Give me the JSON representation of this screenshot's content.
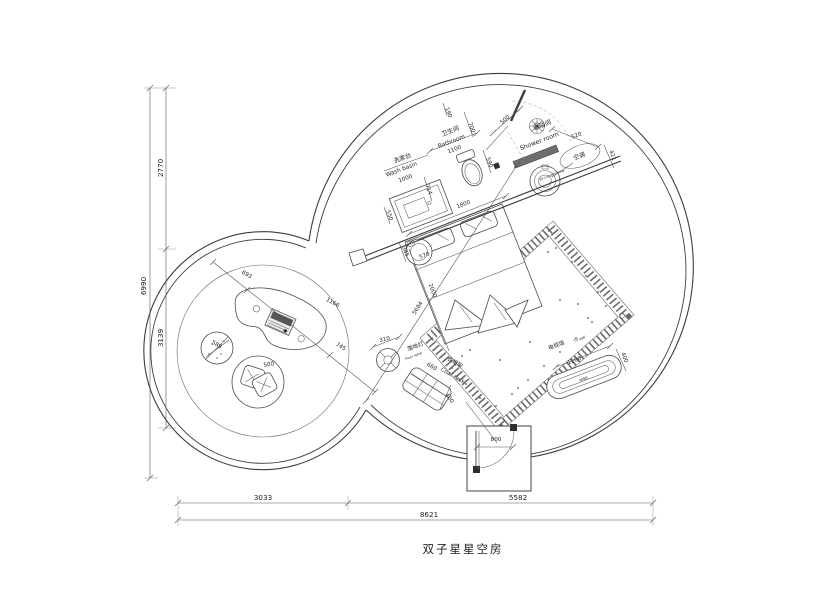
{
  "title": {
    "text": "双子星星空房"
  },
  "drawing": {
    "type": "floor-plan",
    "room_name": "双子星星空房",
    "overall_dimensions": {
      "total_width_mm": 8621,
      "total_height_mm": 6990,
      "bottom_segments_mm": [
        3033,
        5582
      ],
      "left_segments_mm": [
        2770,
        3139
      ]
    },
    "areas": [
      {
        "name_cn": "卫生间",
        "name_en": "Bathroom",
        "width_mm": 1100
      },
      {
        "name_cn": "淋浴间",
        "name_en": "Shower room"
      },
      {
        "name_cn": "洗漱台",
        "name_en": "Wash basin",
        "width_mm": 1000
      },
      {
        "name_cn": "空调",
        "name_en": "air-conditioning"
      },
      {
        "name_cn": "落地灯",
        "name_en": "Floor lamp",
        "dim_mm": 310
      },
      {
        "name_cn": "衣帽架",
        "name_en": "Coat rack",
        "dims_mm": [
          660,
          400
        ]
      },
      {
        "name_cn": "电视墙",
        "name_en": "TV wall",
        "dims_mm": [
          1200,
          400
        ]
      },
      {
        "name_cn": "电视机",
        "name_en": ""
      }
    ],
    "labels": [
      {
        "name": "dim-2770",
        "text": "2770",
        "x": 163,
        "y": 168,
        "rot": -90,
        "size": 7.2
      },
      {
        "name": "dim-3139",
        "text": "3139",
        "x": 163,
        "y": 338,
        "rot": -90,
        "size": 7.2
      },
      {
        "name": "dim-6990",
        "text": "6990",
        "x": 146,
        "y": 286,
        "rot": -90,
        "size": 7.2
      },
      {
        "name": "dim-3033",
        "text": "3033",
        "x": 263,
        "y": 500,
        "rot": 0,
        "size": 7.2
      },
      {
        "name": "dim-5582",
        "text": "5582",
        "x": 518,
        "y": 500,
        "rot": 0,
        "size": 7.2
      },
      {
        "name": "dim-8621",
        "text": "8621",
        "x": 429,
        "y": 517,
        "rot": 0,
        "size": 7.2
      },
      {
        "name": "label-washbasin-cn",
        "text": "洗漱台",
        "x": 403,
        "y": 160,
        "rot": -21,
        "size": 6.2
      },
      {
        "name": "label-washbasin-en",
        "text": "Wash basin",
        "x": 402,
        "y": 171,
        "rot": -21,
        "size": 5.8
      },
      {
        "name": "dim-1000",
        "text": "1000",
        "x": 406,
        "y": 180,
        "rot": -21,
        "size": 5.6
      },
      {
        "name": "dim-550",
        "text": "550",
        "x": 388,
        "y": 216,
        "rot": 69,
        "size": 5.6
      },
      {
        "name": "label-bathroom-cn",
        "text": "卫生间",
        "x": 451,
        "y": 133,
        "rot": -21,
        "size": 6.2
      },
      {
        "name": "label-bathroom-en",
        "text": "Bathroom",
        "x": 452,
        "y": 143,
        "rot": -21,
        "size": 5.8
      },
      {
        "name": "dim-1100",
        "text": "1100",
        "x": 455,
        "y": 151,
        "rot": -21,
        "size": 5.6
      },
      {
        "name": "dim-190",
        "text": "190",
        "x": 447,
        "y": 113,
        "rot": 69,
        "size": 5.6
      },
      {
        "name": "dim-700",
        "text": "700",
        "x": 470,
        "y": 128,
        "rot": 69,
        "size": 5.6
      },
      {
        "name": "dim-500-door",
        "text": "500",
        "x": 506,
        "y": 121,
        "rot": -40,
        "size": 5.6
      },
      {
        "name": "dim-590",
        "text": "590",
        "x": 488,
        "y": 163,
        "rot": 69,
        "size": 5.6
      },
      {
        "name": "dim-714",
        "text": "714",
        "x": 427,
        "y": 190,
        "rot": 69,
        "size": 5.6
      },
      {
        "name": "dim-1800",
        "text": "1800",
        "x": 464,
        "y": 206,
        "rot": -21,
        "size": 5.6
      },
      {
        "name": "label-shower-cn",
        "text": "淋浴间",
        "x": 543,
        "y": 127,
        "rot": -21,
        "size": 6.2
      },
      {
        "name": "label-shower-en",
        "text": "Shower room",
        "x": 540,
        "y": 143,
        "rot": -21,
        "size": 6.2
      },
      {
        "name": "dim-520",
        "text": "520",
        "x": 577,
        "y": 137,
        "rot": -21,
        "size": 5.6
      },
      {
        "name": "dim-421",
        "text": "421",
        "x": 611,
        "y": 156,
        "rot": 69,
        "size": 5.6
      },
      {
        "name": "label-ac-cn",
        "text": "空调",
        "x": 580,
        "y": 158,
        "rot": -21,
        "size": 6.0
      },
      {
        "name": "label-ac-en",
        "text": "air-conditioning",
        "x": 552,
        "y": 176,
        "rot": -21,
        "size": 3.4
      },
      {
        "name": "dim-385",
        "text": "385",
        "x": 404,
        "y": 252,
        "rot": 69,
        "size": 5.6
      },
      {
        "name": "dim-570",
        "text": "570",
        "x": 425,
        "y": 257,
        "rot": -21,
        "size": 5.6
      },
      {
        "name": "dim-2000",
        "text": "2000",
        "x": 431,
        "y": 291,
        "rot": 69,
        "size": 5.6
      },
      {
        "name": "dim-5684",
        "text": "5684",
        "x": 419,
        "y": 309,
        "rot": -57,
        "size": 5.6
      },
      {
        "name": "dim-310",
        "text": "310",
        "x": 385,
        "y": 341,
        "rot": -12,
        "size": 5.6
      },
      {
        "name": "label-floorlamp-cn",
        "text": "落地灯",
        "x": 416,
        "y": 348,
        "rot": -21,
        "size": 5.6
      },
      {
        "name": "label-floorlamp-en",
        "text": "Floor lamp",
        "x": 414,
        "y": 357,
        "rot": -21,
        "size": 3.4
      },
      {
        "name": "dim-660",
        "text": "660",
        "x": 431,
        "y": 368,
        "rot": 30,
        "size": 5.6
      },
      {
        "name": "label-coatrack-cn",
        "text": "衣帽架",
        "x": 454,
        "y": 364,
        "rot": 30,
        "size": 5.6
      },
      {
        "name": "label-coatrack-en",
        "text": "Coat rack",
        "x": 452,
        "y": 377,
        "rot": 30,
        "size": 5.6
      },
      {
        "name": "dim-400-rack",
        "text": "400",
        "x": 448,
        "y": 399,
        "rot": 55,
        "size": 5.6
      },
      {
        "name": "label-tvwall-cn",
        "text": "电视墙",
        "x": 557,
        "y": 347,
        "rot": -21,
        "size": 5.6
      },
      {
        "name": "label-tvwall-en",
        "text": "TV wall",
        "x": 580,
        "y": 340,
        "rot": -21,
        "size": 3.4
      },
      {
        "name": "dim-1200",
        "text": "1200",
        "x": 575,
        "y": 362,
        "rot": -21,
        "size": 5.6
      },
      {
        "name": "label-tv-unit",
        "text": "电视机",
        "x": 584,
        "y": 380,
        "rot": -21,
        "size": 3.0
      },
      {
        "name": "dim-400-tv",
        "text": "400",
        "x": 623,
        "y": 358,
        "rot": 69,
        "size": 5.6
      },
      {
        "name": "dim-693",
        "text": "693",
        "x": 246,
        "y": 276,
        "rot": 29,
        "size": 5.6
      },
      {
        "name": "dim-1166",
        "text": "1166",
        "x": 332,
        "y": 304,
        "rot": 29,
        "size": 5.6
      },
      {
        "name": "dim-745",
        "text": "745",
        "x": 340,
        "y": 348,
        "rot": 29,
        "size": 5.6
      },
      {
        "name": "dim-589",
        "text": "589",
        "x": 216,
        "y": 346,
        "rot": 29,
        "size": 5.6
      },
      {
        "name": "dim-500-chair",
        "text": "500",
        "x": 269,
        "y": 366,
        "rot": -8,
        "size": 5.6
      },
      {
        "name": "dim-800",
        "text": "800",
        "x": 496,
        "y": 441,
        "rot": 0,
        "size": 5.6
      }
    ]
  }
}
